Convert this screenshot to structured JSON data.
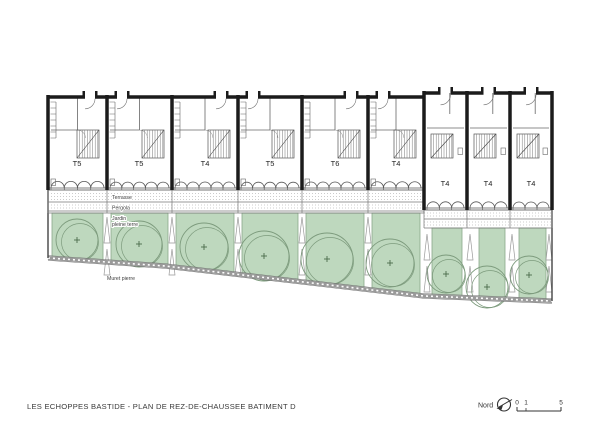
{
  "title": "LES ECHOPPES BASTIDE - PLAN DE REZ-DE-CHAUSSEE BATIMENT D",
  "units": [
    {
      "label": "T5"
    },
    {
      "label": "T5"
    },
    {
      "label": "T4"
    },
    {
      "label": "T5"
    },
    {
      "label": "T6"
    },
    {
      "label": "T4"
    },
    {
      "label": "T4"
    },
    {
      "label": "T4"
    },
    {
      "label": "T4"
    }
  ],
  "annotations": {
    "terrasse": "Terrasse",
    "pergola": "Pergola",
    "jardin_line1": "Jardin",
    "jardin_line2": "pleine terre",
    "muret": "Muret pierre"
  },
  "compass": {
    "label": "Nord"
  },
  "scale_bar": {
    "tick_0": "0",
    "tick_1": "1",
    "tick_5": "5"
  },
  "colors": {
    "garden_fill": "#bed8be",
    "garden_edge": "#8aa88a",
    "tree_outline": "#7d9b7d",
    "tree_cross": "#4a6b4a",
    "wall": "#1b1b1b",
    "line": "#5a5a5a",
    "muret": "#9a9a9a"
  }
}
